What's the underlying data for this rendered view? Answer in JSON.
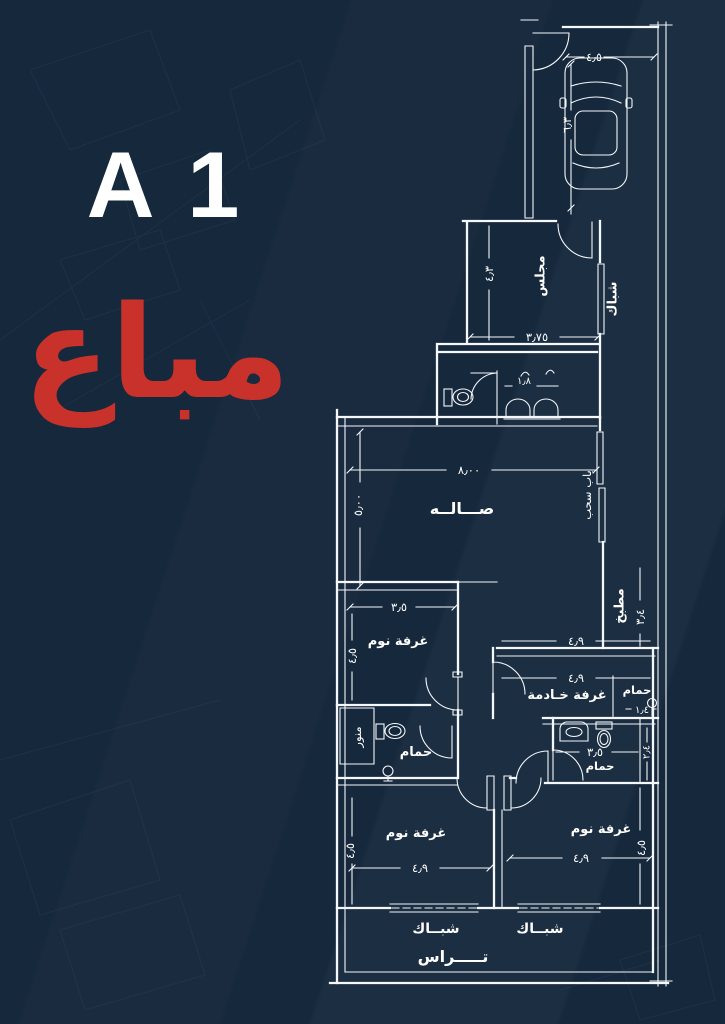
{
  "page": {
    "background_color": "#16283c",
    "line_color": "#f4f7fb",
    "unit_label": "A 1",
    "status_label": "مباع",
    "status_color": "#c9322b"
  },
  "plan": {
    "rooms": {
      "majlis": "مجلس",
      "hall": "صـــالــه",
      "bedroom": "غرفة نوم",
      "maid_room": "غرفة خـادمة",
      "bathroom": "حمام",
      "kitchen": "مطبخ",
      "light_well": "منور",
      "terrace": "تـــــراس"
    },
    "openings": {
      "window": "شباك",
      "window_wide": "شبــاك",
      "sliding_door": "باب سحب"
    },
    "dimensions": {
      "parking_width": "٤٫٥",
      "parking_depth": "٦٫٣",
      "majlis_width": "٣٫٧٥",
      "majlis_height": "٤٫٣",
      "wc_width": "١٫٨",
      "hall_width": "٨٫٠٠",
      "hall_height": "٥٫٠٠",
      "bedroom1_width": "٣٫٥",
      "bedroom1_height": "٤٫٥",
      "kitchen_width": "٤٫٩",
      "kitchen_depth": "٣٫٤",
      "maid_width": "٤٫٩",
      "maid_bath_width": "١٫٤",
      "bath_width": "٣٫٥",
      "bath_height": "٢٫٤",
      "bedroom2_width": "٤٫٩",
      "bedroom2_height": "٤٫٥",
      "bedroom3_width": "٤٫٩",
      "bedroom3_height": "٤٫٥"
    }
  }
}
